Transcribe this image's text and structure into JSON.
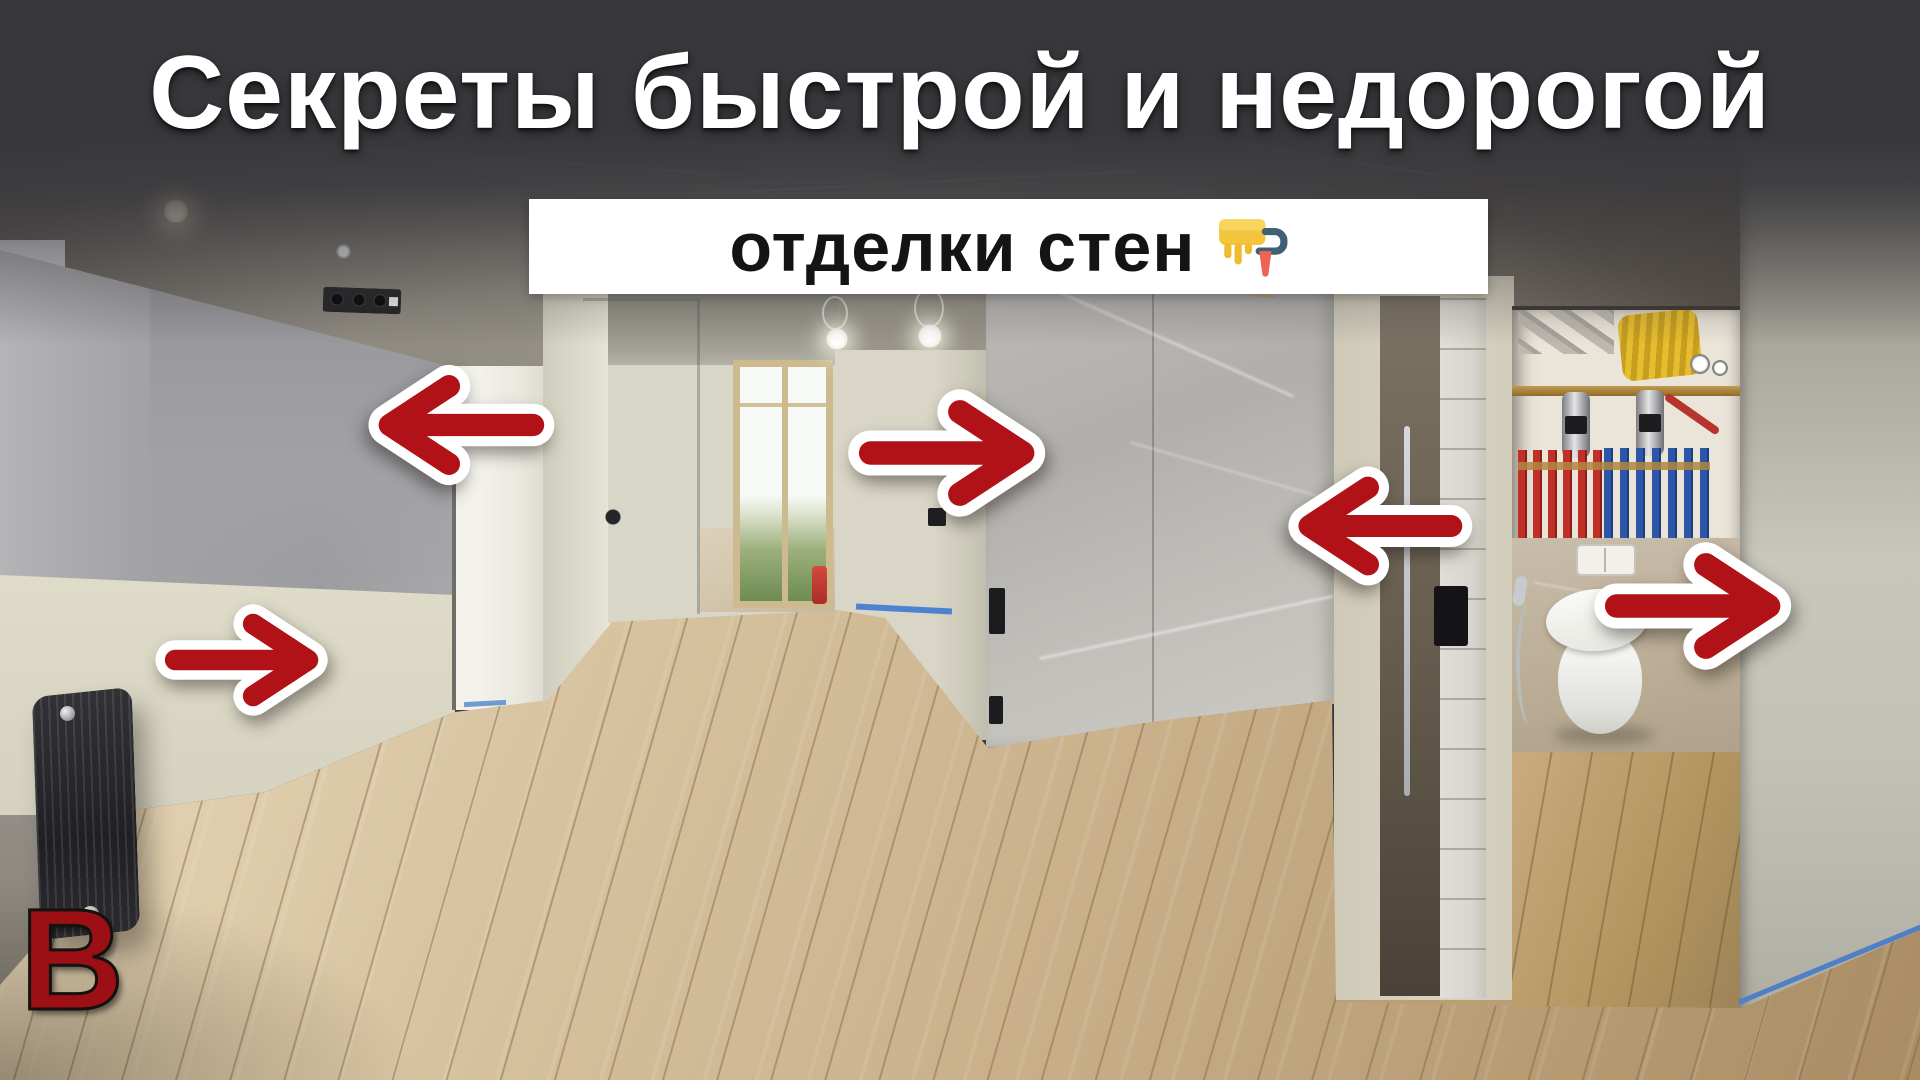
{
  "title": {
    "text": "Секреты быстрой и недорогой"
  },
  "banner": {
    "text": "отделки стен",
    "icon": "paint-roller"
  },
  "watermark": {
    "text": "В"
  },
  "colors": {
    "accent_red": "#b01217",
    "watermark_red": "#9c1015",
    "banner_bg": "#ffffff",
    "title_text": "#ffffff",
    "banner_text": "#141414",
    "top_overlay": "#38373b"
  },
  "annotations": {
    "arrows": [
      {
        "direction": "left",
        "target": "plastered wall (living room)"
      },
      {
        "direction": "right",
        "target": "marble slab panel"
      },
      {
        "direction": "left",
        "target": "marble slab panel (right side)"
      },
      {
        "direction": "right",
        "target": "bathroom wall"
      },
      {
        "direction": "right",
        "target": "painted wall (near radiator)"
      }
    ]
  },
  "scene": {
    "description": "apartment under renovation: plastered walls, wood-look floor, black radiator, marble wall panel, bathroom niche with plumbing manifold and wall-hung toilet"
  }
}
